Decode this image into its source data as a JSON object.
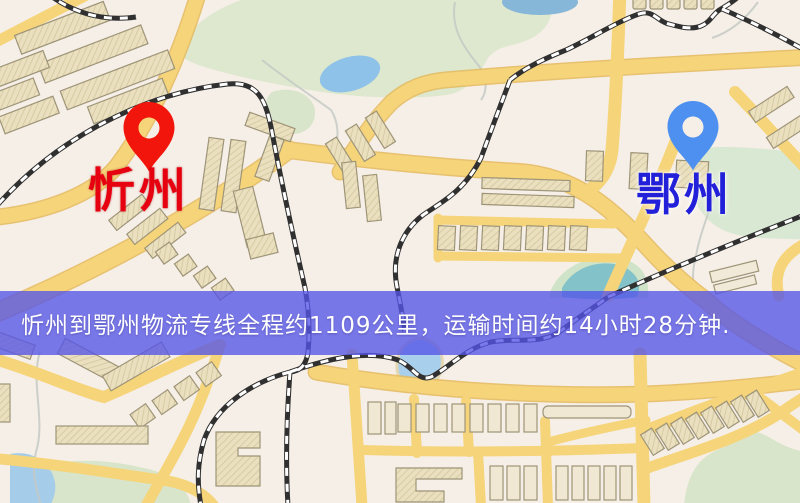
{
  "banner": {
    "text": "忻州到鄂州物流专线全程约1109公里，运输时间约14小时28分钟.",
    "background_color": "#5454e8",
    "text_color": "#ffffff",
    "distance_km": "1109",
    "duration": "14小时28分钟"
  },
  "origin": {
    "label": "忻州",
    "label_color": "#e60010",
    "pin_color": "#f2150b",
    "icon": "map-pin"
  },
  "destination": {
    "label": "鄂州",
    "label_color": "#2220d8",
    "pin_color": "#4e90f0",
    "icon": "map-pin"
  },
  "map_palette": {
    "background": "#f6efe7",
    "road": "#f5d47a",
    "road_edge": "#e5ba5c",
    "park": "#dbe7cd",
    "water": "#93c2e8",
    "building": "#eae0bf",
    "building_outline": "#9e9478",
    "railway": "#303030"
  }
}
